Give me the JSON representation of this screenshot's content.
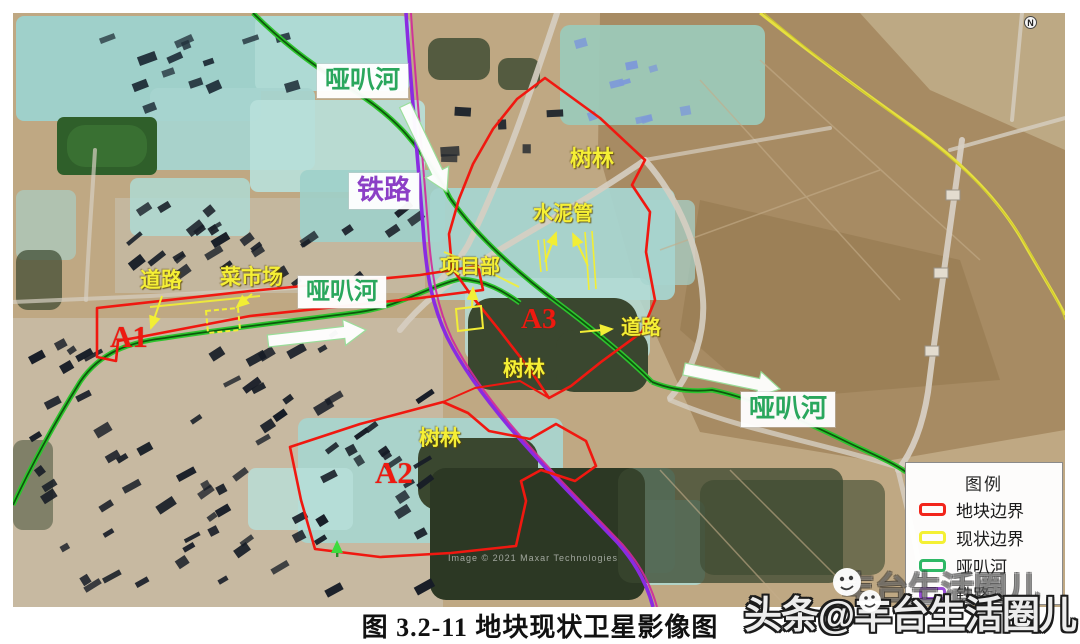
{
  "figure_caption": "图 3.2-11 地块现状卫星影像图",
  "map": {
    "compass_label": "N",
    "attribution": "Image © 2021 Maxar Technologies",
    "labels": {
      "river_top": "哑叭河",
      "railway": "铁路",
      "river_mid": "哑叭河",
      "river_se": "哑叭河",
      "road_west": "道路",
      "market": "菜市场",
      "project_office": "项目部",
      "cement_pipes": "水泥管",
      "forest_ne": "树林",
      "forest_mid": "树林",
      "forest_sw": "树林",
      "road_east": "道路",
      "parcel_a1": "A1",
      "parcel_a2": "A2",
      "parcel_a3": "A3"
    },
    "line_colors": {
      "parcel_boundary": "#f01810",
      "status_boundary": "#f2ee35",
      "river": "#2ec42e",
      "railway": "#8a2be2"
    }
  },
  "legend": {
    "title": "图例",
    "items": [
      {
        "label": "地块边界",
        "color": "#f2251b"
      },
      {
        "label": "现状边界",
        "color": "#f4f033"
      },
      {
        "label": "哑叭河",
        "color": "#2eb865"
      },
      {
        "label": "铁路",
        "color": "#9a4fd6"
      }
    ]
  },
  "watermark": {
    "text": "头条@丰台生活圈儿",
    "text_secondary": "丰台生活圈儿"
  }
}
